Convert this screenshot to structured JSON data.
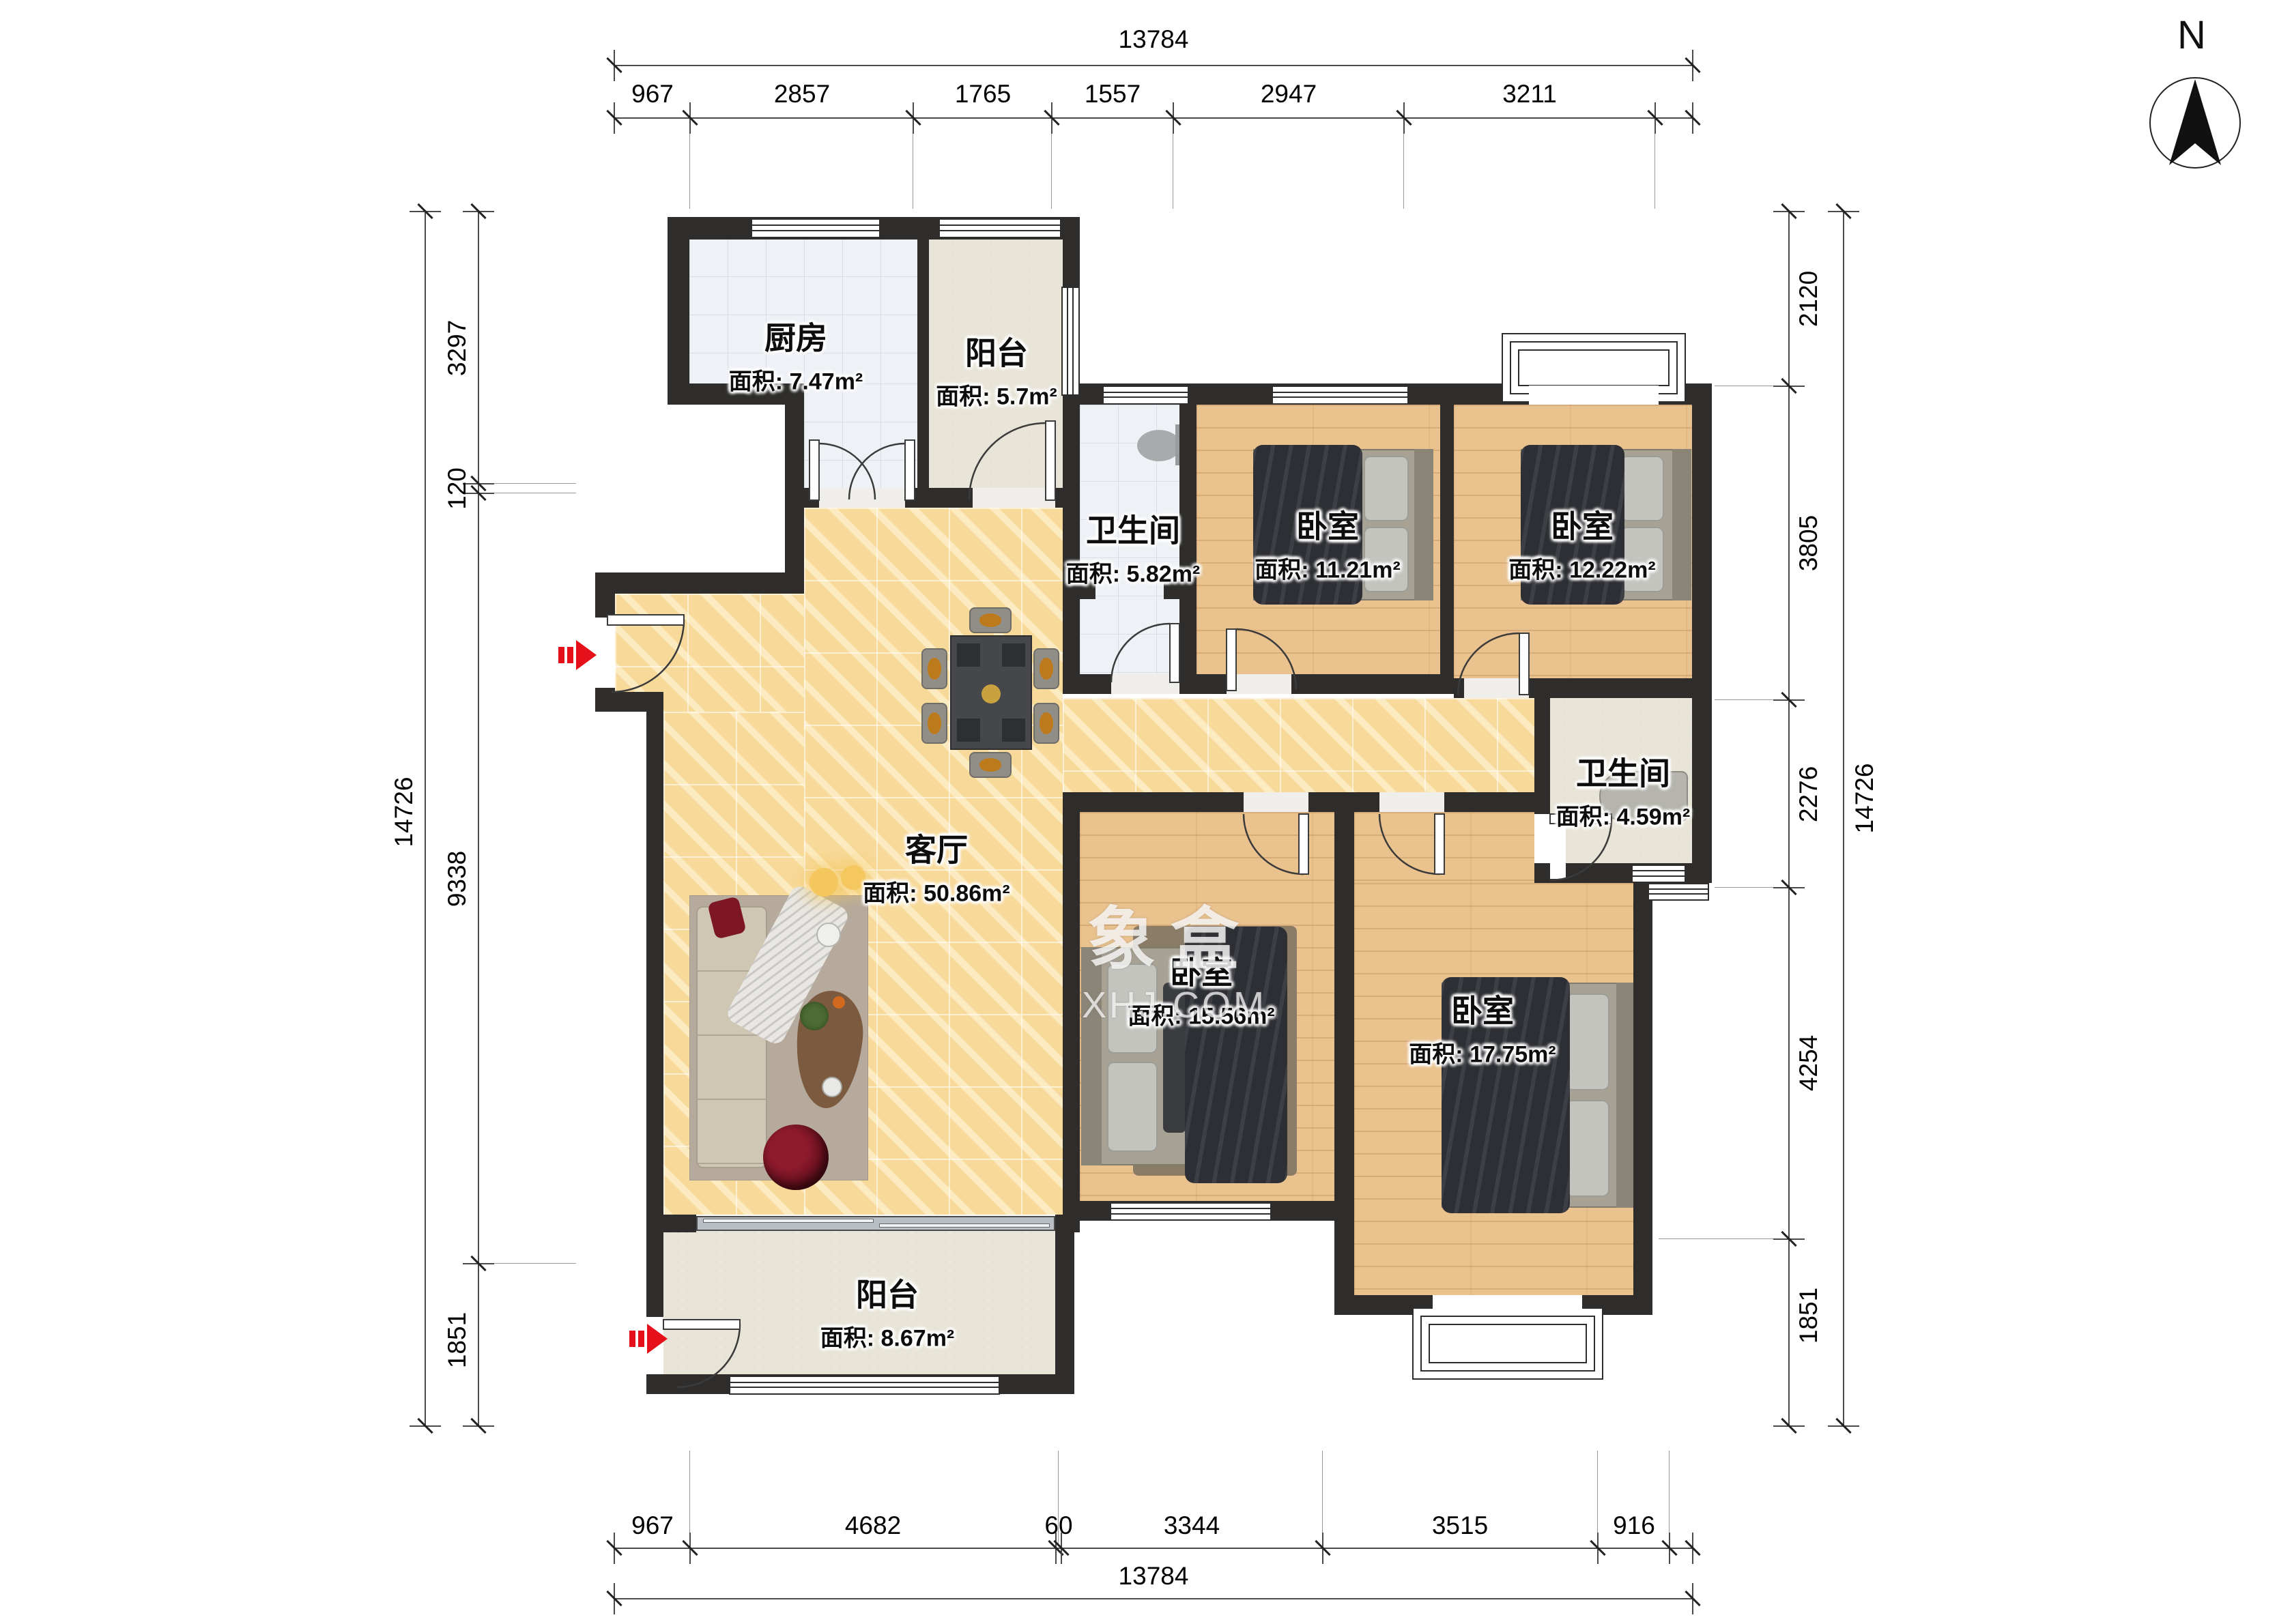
{
  "compass": {
    "label": "N"
  },
  "watermark": {
    "brand": "象盒",
    "domain": "XHJ.COM"
  },
  "rooms": [
    {
      "name": "厨房",
      "area": "面积: 7.47m²"
    },
    {
      "name": "阳台",
      "area": "面积: 5.7m²"
    },
    {
      "name": "卫生间",
      "area": "面积: 5.82m²"
    },
    {
      "name": "卧室",
      "area": "面积: 11.21m²"
    },
    {
      "name": "卧室",
      "area": "面积: 12.22m²"
    },
    {
      "name": "卫生间",
      "area": "面积: 4.59m²"
    },
    {
      "name": "客厅",
      "area": "面积: 50.86m²"
    },
    {
      "name": "卧室",
      "area": "面积: 15.56m²"
    },
    {
      "name": "卧室",
      "area": "面积: 17.75m²"
    },
    {
      "name": "阳台",
      "area": "面积: 8.67m²"
    }
  ],
  "dimensions": {
    "top": {
      "total": "13784",
      "segments": [
        "967",
        "2857",
        "1765",
        "1557",
        "2947",
        "3211"
      ]
    },
    "bottom": {
      "total": "13784",
      "segments": [
        "967",
        "4682",
        "60",
        "3344",
        "3515",
        "916"
      ]
    },
    "left": {
      "total": "14726",
      "segments": [
        "3297",
        "120",
        "9338",
        "1851"
      ]
    },
    "right": {
      "total": "14726",
      "segments": [
        "2120",
        "3805",
        "2276",
        "4254",
        "1851"
      ]
    }
  }
}
